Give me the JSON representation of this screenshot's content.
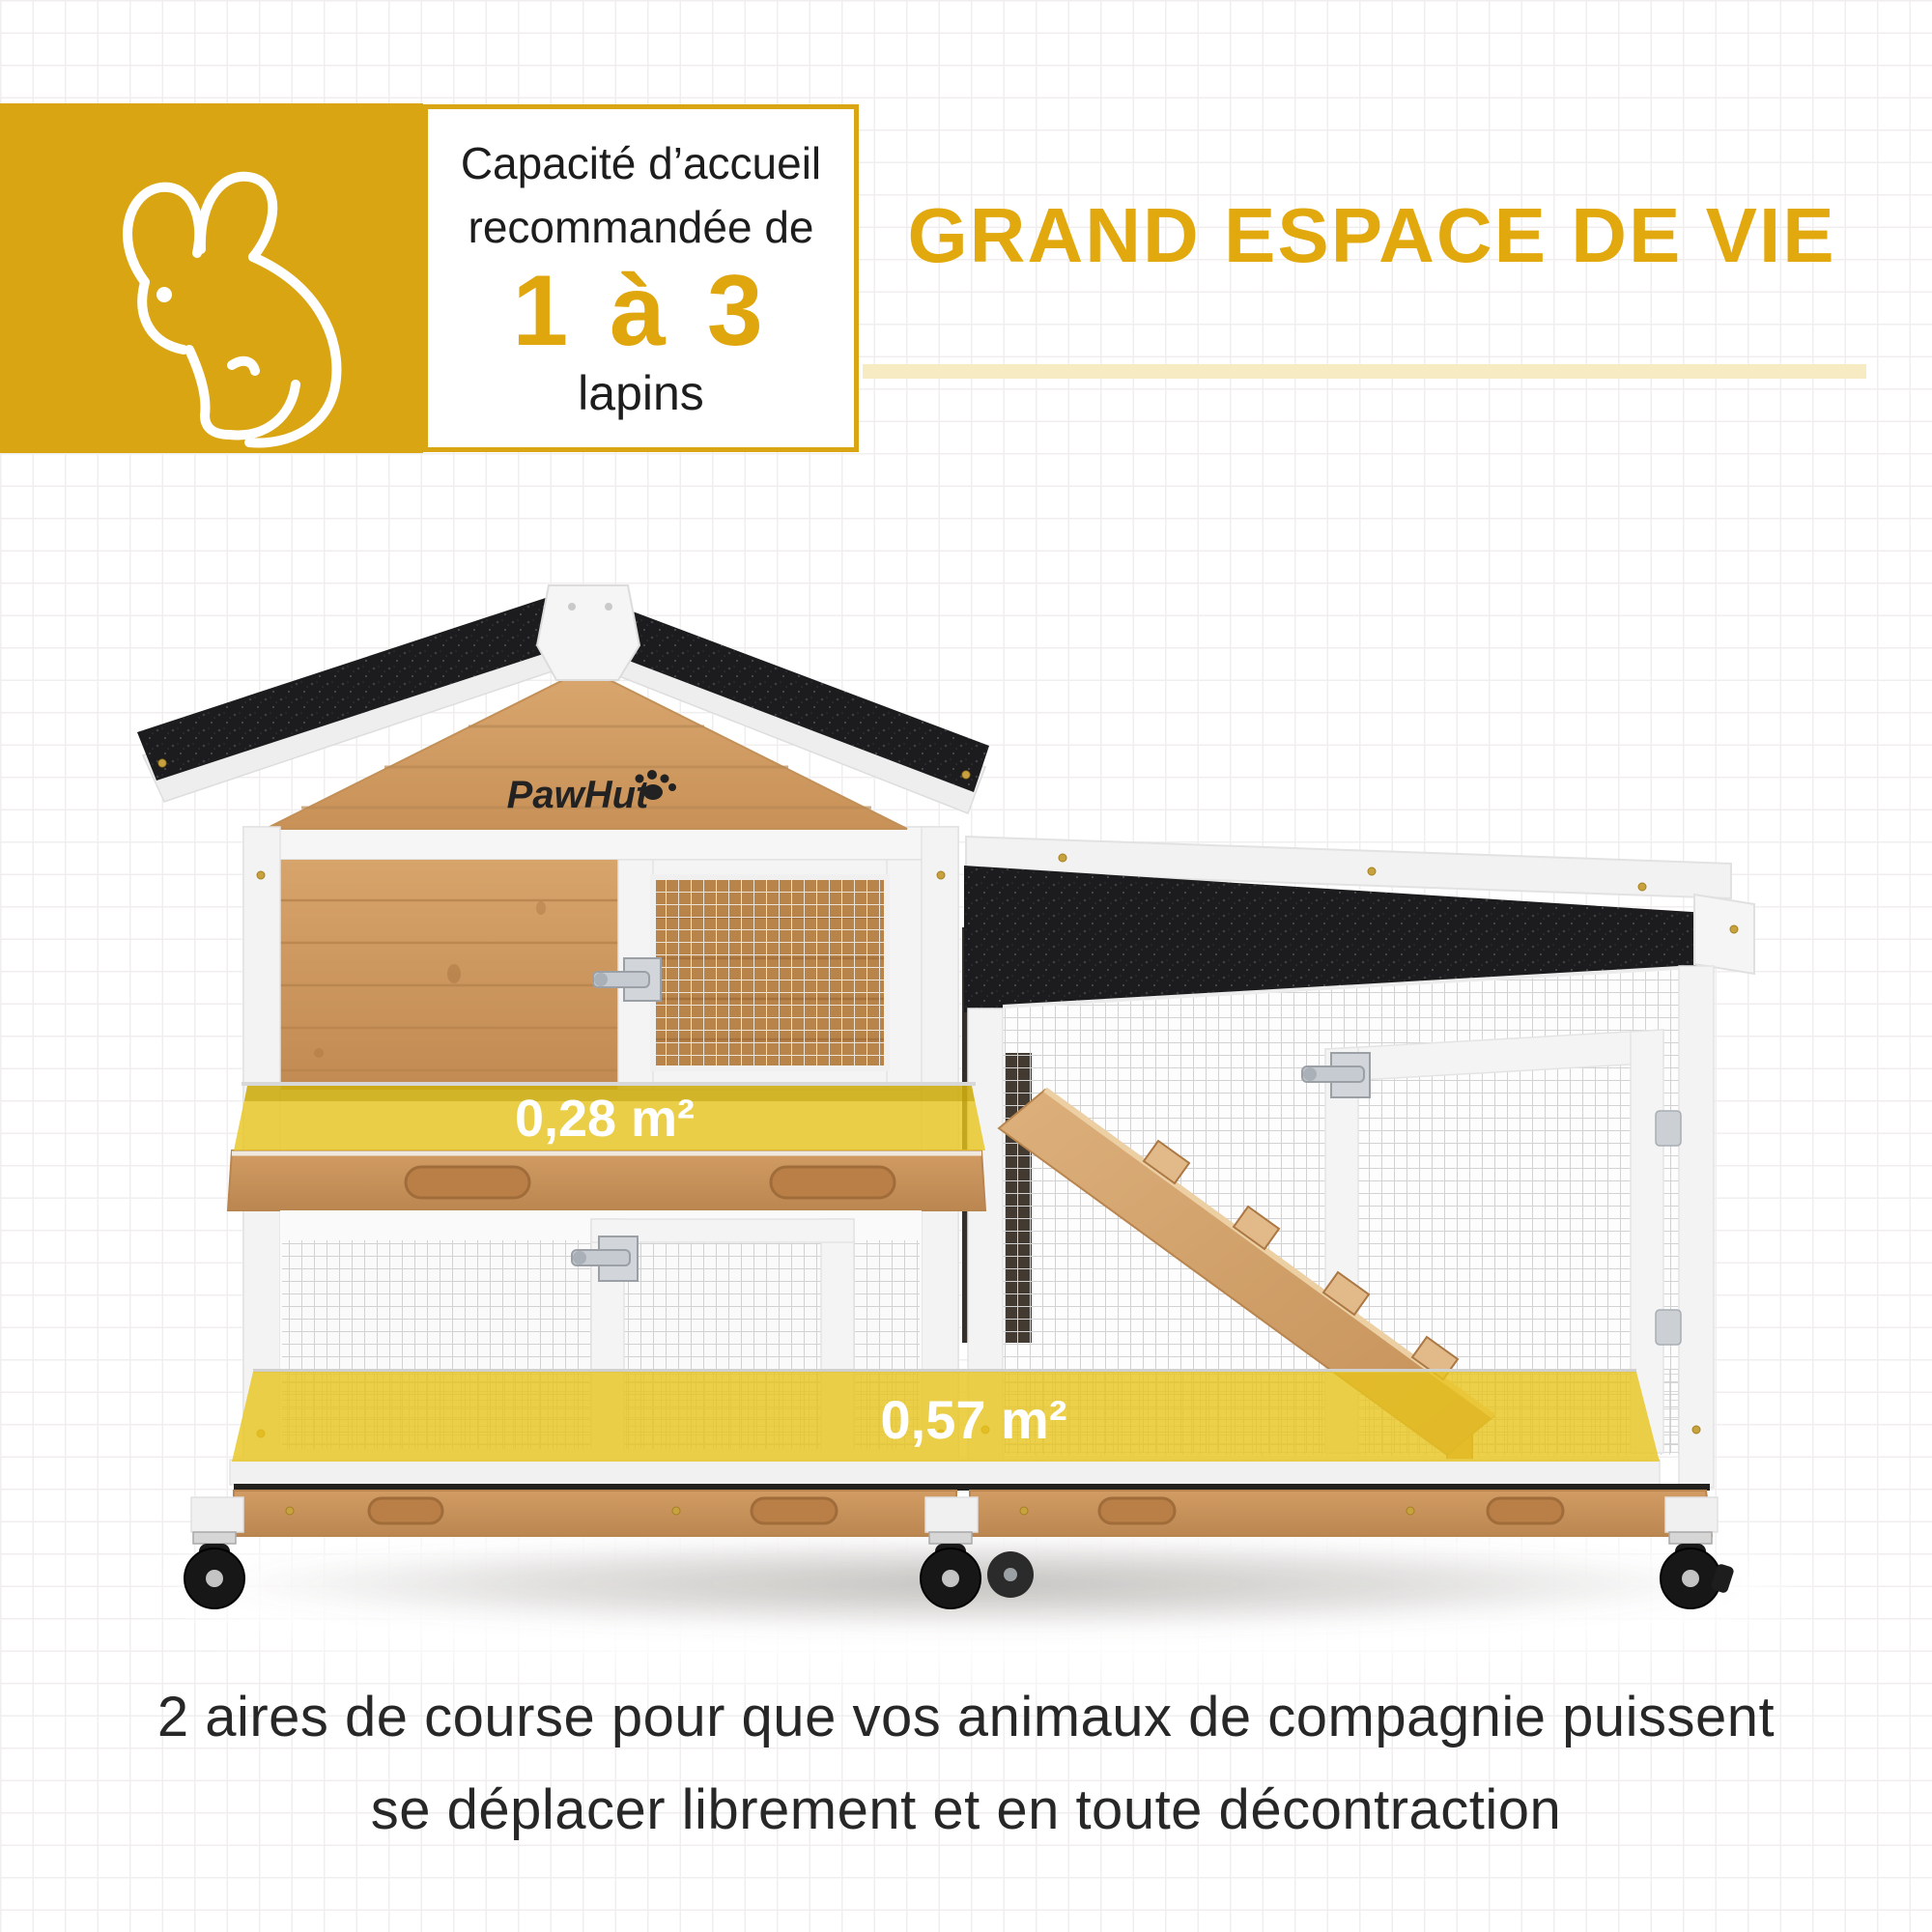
{
  "capacity_badge": {
    "title_line1": "Capacité d’accueil",
    "title_line2": "recommandée de",
    "range": "1 à 3",
    "unit": "lapins"
  },
  "section_heading": {
    "title": "GRAND ESPACE DE VIE"
  },
  "product_photo": {
    "brand_logo": "PawHut",
    "upper_area_label": "0,28 m²",
    "lower_area_label": "0,57 m²"
  },
  "caption": {
    "line1": "2 aires de course pour que vos animaux de compagnie puissent",
    "line2": "se déplacer librement et en toute décontraction"
  },
  "colors": {
    "accent": "#D9A512",
    "heading_text": "#E2A90F",
    "underline": "#F6EBC3",
    "overlay_yellow": "#E8C41D",
    "roof_black": "#1C1C1E",
    "wood": "#D09A63"
  }
}
